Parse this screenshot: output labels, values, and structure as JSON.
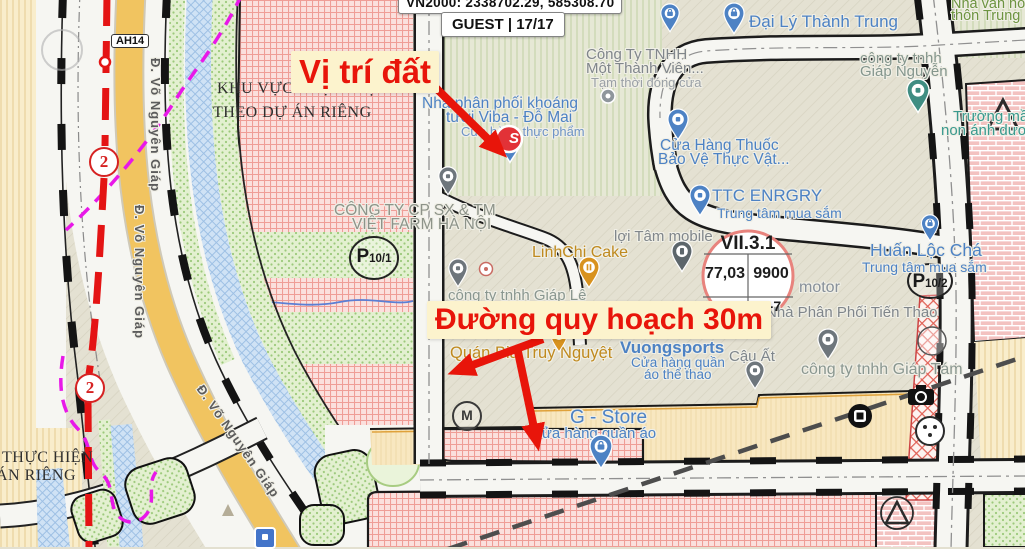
{
  "header": {
    "coords": "VN2000: 2338702.29, 585308.70",
    "session": "GUEST | 17/17",
    "scale": "100 m"
  },
  "annotations": {
    "site": "Vị trí đất",
    "road": "Đường quy hoạch 30m",
    "accent_color": "#e8150a",
    "box_color": "#fcf3cd"
  },
  "planning": {
    "zone_note": {
      "l1": "KHU VỰC THỰC HIỆN",
      "l2": "THEO DỰ ÁN RIÊNG"
    },
    "zone_note_sw": {
      "l1": "THỰC HIỆN",
      "l2": "ÁN RIÊNG"
    },
    "plot_circle": {
      "code": "VII.3.1",
      "a": "77,03",
      "b": "9900",
      "c": "25,1 44,8",
      "d": "2-7"
    },
    "parking_1": {
      "p": "P",
      "sub": "10/1"
    },
    "parking_2": {
      "p": "P",
      "sub": "10/2"
    },
    "route_badge": "2",
    "highway_shield": "AH14"
  },
  "roads": {
    "vo_nguyen_giap": "Đ. Võ Nguyên Giáp"
  },
  "poi": {
    "dai_ly": "Đại Lý Thành Trung",
    "nha_van_hoa": {
      "l1": "Nhà văn hóa",
      "l2": "thôn Trung"
    },
    "cong_ty_mtv": {
      "l1": "Công Ty TNHH",
      "l2": "Một Thành Viên...",
      "l3": "Tạm thời đóng cửa"
    },
    "giap_nguyen": {
      "l1": "công ty tnhh",
      "l2": "Giáp Nguyễn"
    },
    "truong_mam_non": {
      "l1": "Trường mầm",
      "l2": "non ánh dương"
    },
    "nha_phan_phoi": {
      "l1": "Nhà phân phối khoáng",
      "l2": "tươi Viba - Đỗ Mai",
      "l3": "Cửa hàng thực phẩm"
    },
    "cua_hang_thuoc": {
      "l1": "Cửa Hàng Thuốc",
      "l2": "Bảo Vệ Thực Vật..."
    },
    "ttc": {
      "l1": "TTC ENRGRY",
      "l2": "Trung tâm mua sắm"
    },
    "viet_farm": {
      "l1": "CÔNG TY CP SX & TM",
      "l2": "VIỆT FARM HÀ NỘI"
    },
    "loi_tam": "lợi Tâm mobile",
    "linhchi": "LinhChi Cake",
    "giap_le": "công ty tnhh Giáp Lê",
    "huan_loc": {
      "l1": "Huấn Lộc Chá",
      "l2": "Trung tâm mua sắm"
    },
    "motor": "motor",
    "tien_thao": "Nhà Phân Phối Tiến Thao",
    "quan_bia": "Quán Bia Truy Nguyệt",
    "vuongsports": {
      "l1": "Vuongsports",
      "l2": "Cửa hàng quần",
      "l3": "áo thể thao"
    },
    "cau_at": "Cậu Ất",
    "g_store": {
      "l1": "G - Store",
      "l2": "Cửa hàng quần áo"
    },
    "giap_tam": "công ty tnhh Giáp Tám"
  },
  "icons": {
    "m_logo": "M",
    "site_logo": "S"
  }
}
